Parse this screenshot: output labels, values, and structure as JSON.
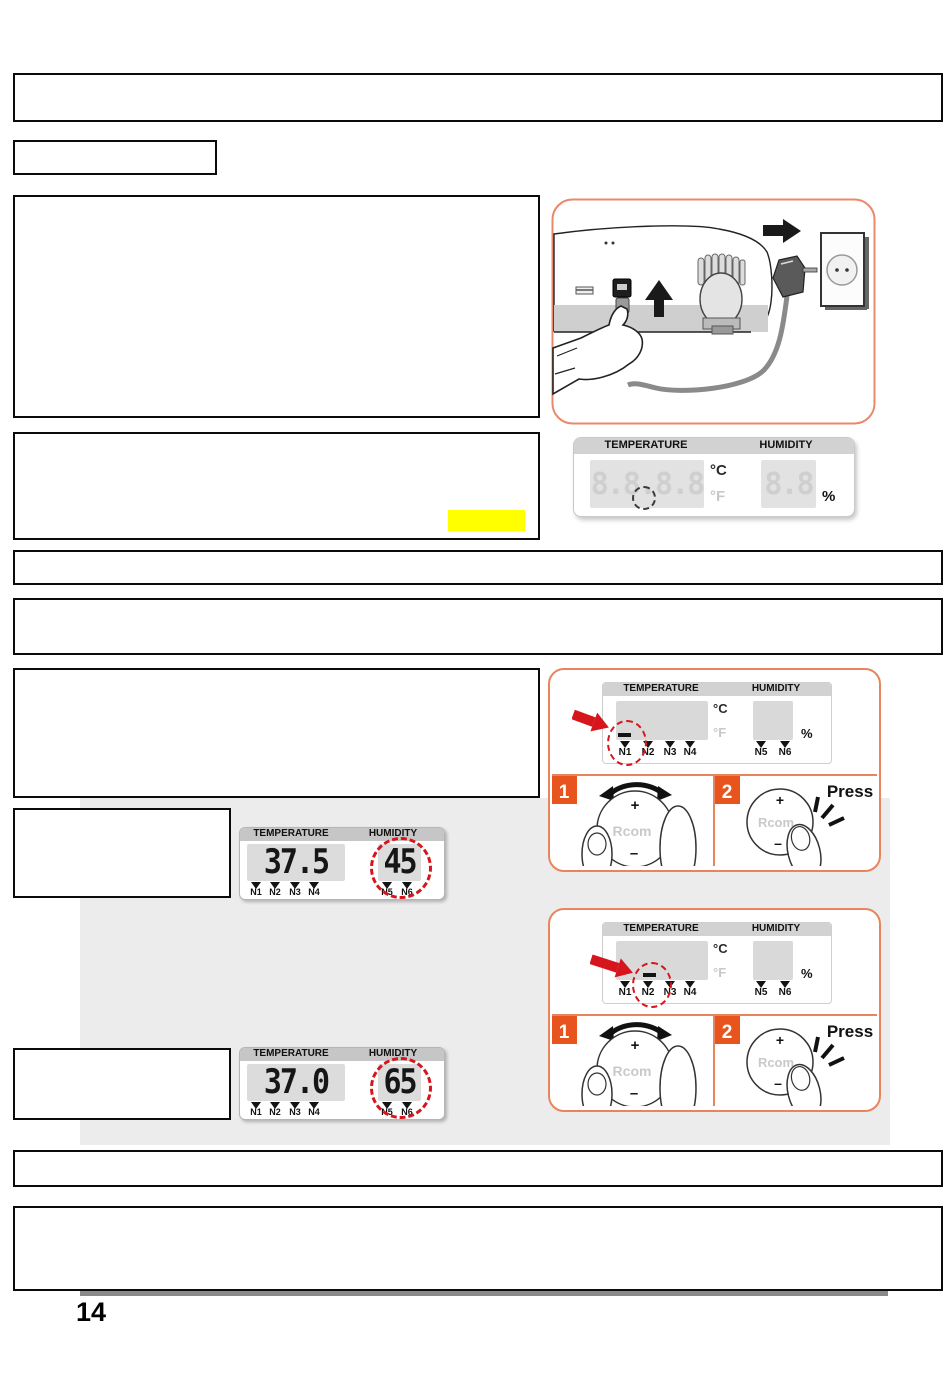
{
  "page_number": "14",
  "colors": {
    "accent_orange": "#e8541e",
    "panel_border": "#e8855c",
    "highlight_red": "#d6161c",
    "marker_yellow": "#ffff00",
    "band_gray": "#ececec"
  },
  "lcd_blank": {
    "temperature_label": "TEMPERATURE",
    "humidity_label": "HUMIDITY",
    "temperature_value": "8.8.8.8",
    "humidity_value": "8.8",
    "unit_c": "°C",
    "unit_f": "°F",
    "unit_percent": "%"
  },
  "panels": [
    {
      "temperature_label": "TEMPERATURE",
      "humidity_label": "HUMIDITY",
      "unit_c": "°C",
      "unit_f": "°F",
      "unit_percent": "%",
      "nodes": [
        "N1",
        "N2",
        "N3",
        "N4",
        "N5",
        "N6"
      ],
      "highlighted_node": "N1",
      "step1": "1",
      "step2": "2",
      "knob_brand": "Rcom",
      "knob_plus": "+",
      "knob_minus": "–",
      "press_label": "Press"
    },
    {
      "temperature_label": "TEMPERATURE",
      "humidity_label": "HUMIDITY",
      "unit_c": "°C",
      "unit_f": "°F",
      "unit_percent": "%",
      "nodes": [
        "N1",
        "N2",
        "N3",
        "N4",
        "N5",
        "N6"
      ],
      "highlighted_node": "N2",
      "step1": "1",
      "step2": "2",
      "knob_brand": "Rcom",
      "knob_plus": "+",
      "knob_minus": "–",
      "press_label": "Press"
    }
  ],
  "readouts": [
    {
      "temperature_label": "TEMPERATURE",
      "humidity_label": "HUMIDITY",
      "temperature_value": "37.5",
      "humidity_value": "45",
      "temp_nodes": [
        "N1",
        "N2",
        "N3",
        "N4"
      ],
      "hum_nodes": [
        "N5",
        "N6"
      ]
    },
    {
      "temperature_label": "TEMPERATURE",
      "humidity_label": "HUMIDITY",
      "temperature_value": "37.0",
      "humidity_value": "65",
      "temp_nodes": [
        "N1",
        "N2",
        "N3",
        "N4"
      ],
      "hum_nodes": [
        "N5",
        "N6"
      ]
    }
  ]
}
